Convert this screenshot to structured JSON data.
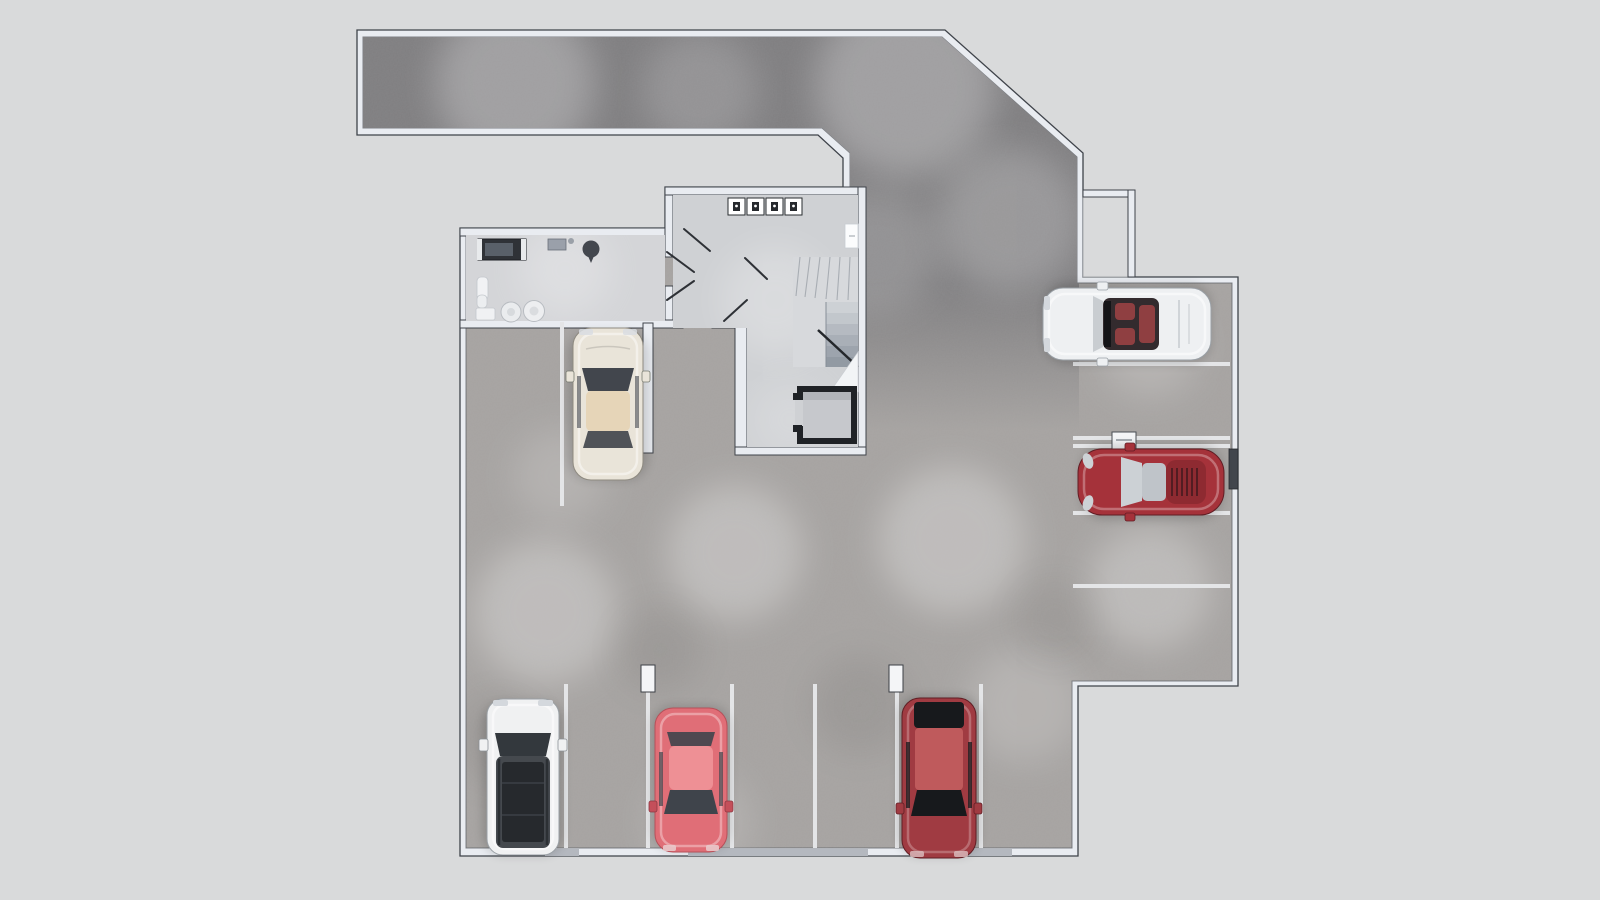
{
  "scene": {
    "background": "#d9dadb",
    "wall_fill": "#e9ecf1",
    "wall_edge": "#3f434a",
    "garage_floor": "#a6a3a1",
    "ramp_floor": "#7f7e80",
    "utility_floor": "#d4d5d8",
    "core_floor": "#cfd1d4",
    "stair_fill": "#d7d9dc",
    "elevator_shaft": "#1f2226",
    "elevator_cab": "#c6c8cc",
    "line_color": "#e4e5e7",
    "post_fill": "#f4f5f7",
    "pocket_fill": "#d9dadb",
    "niche_fill": "#42464d",
    "dark_wall_segment": "#b4b8bf"
  },
  "rooms": {
    "ramp_label": "driveway ramp",
    "garage_label": "parking hall",
    "utility_label": "technical room",
    "core_label": "stair and elevator core",
    "meter_boxes": 4
  },
  "parking": {
    "bottom_row_spaces": 7,
    "right_column_spaces": 5,
    "occupied_spaces": 6,
    "bottom_divider_lines": 6,
    "right_divider_lines": 5,
    "column_posts": 2,
    "wheel_stop_boxes": 1
  },
  "cars": [
    {
      "name": "cream coupe",
      "body": "#e9e4d9",
      "glass": "#42464d",
      "roof": "#e6d5b8",
      "trim": "#c9cdd2"
    },
    {
      "name": "white suv",
      "body": "#f0f1f2",
      "glass": "#33383d",
      "roof": "#45494e",
      "trim": "#26292d"
    },
    {
      "name": "coral hatchback",
      "body": "#e06e77",
      "glass": "#3f444b",
      "roof": "#ee9095",
      "trim": "#c44f5a"
    },
    {
      "name": "dark red sedan",
      "body": "#a03b42",
      "glass": "#17191c",
      "roof": "#bf5a5c",
      "trim": "#732931"
    },
    {
      "name": "white convertible",
      "body": "#eef0f2",
      "glass": "#c9cdd1",
      "roof": "#332b2e",
      "trim": "#8f3f41"
    },
    {
      "name": "red sports car",
      "body": "#a5323a",
      "glass": "#ccd1d5",
      "roof": "#bfc4c9",
      "trim": "#8e2a31"
    }
  ]
}
